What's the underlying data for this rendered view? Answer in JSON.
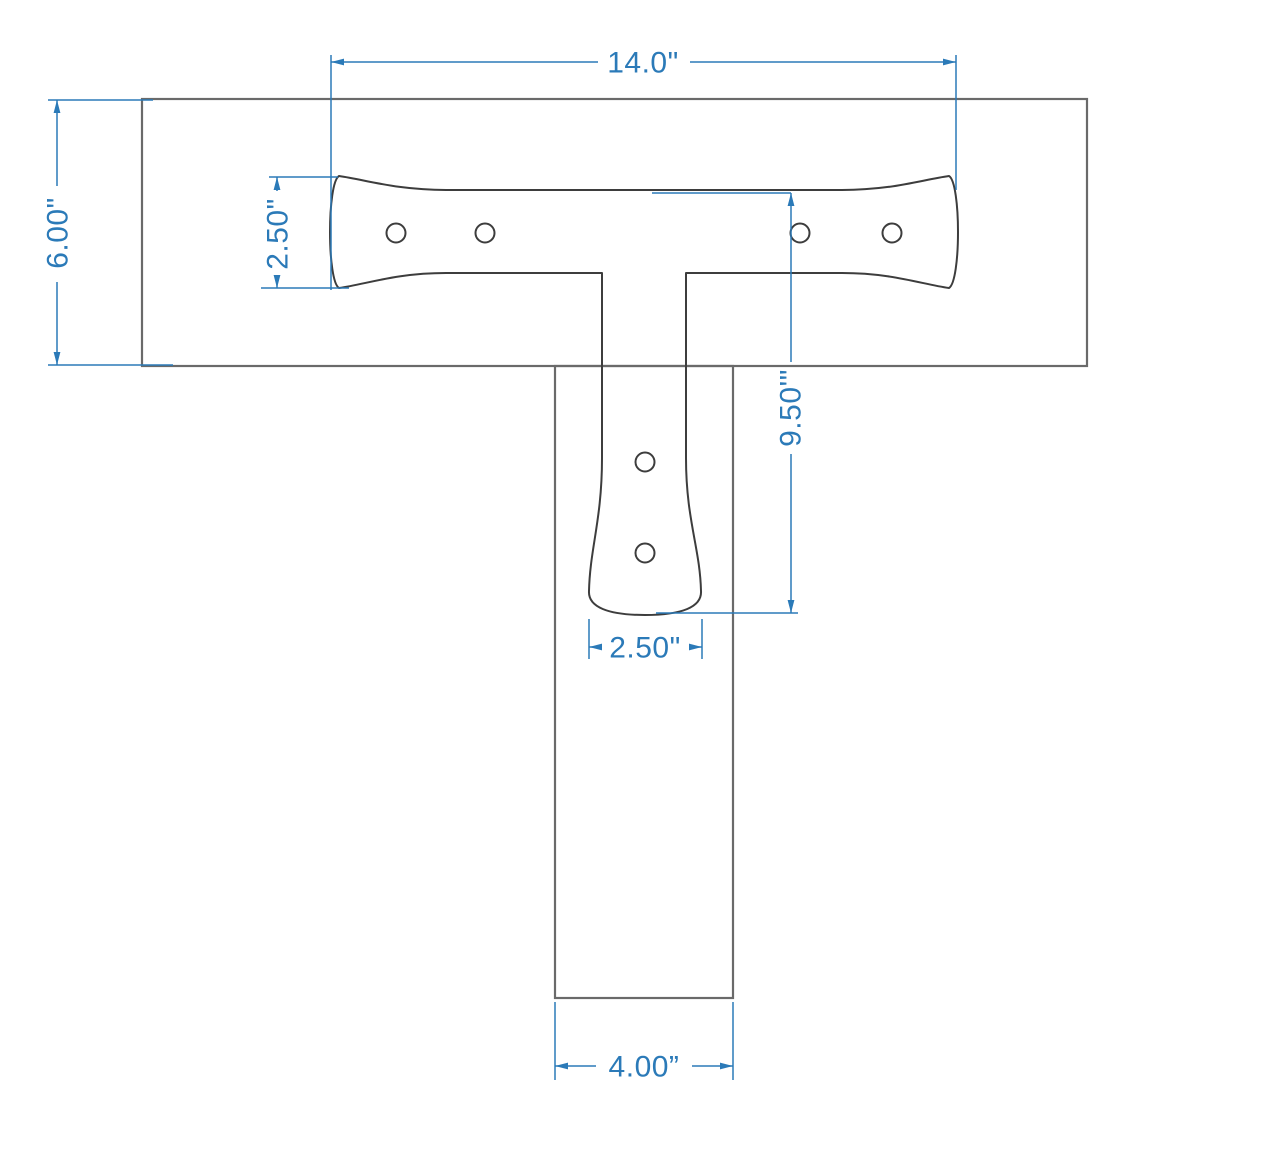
{
  "drawing": {
    "type": "dimensioned-technical-drawing",
    "subject": "T-shaped tie plate over post and beam joint",
    "units": "inches"
  },
  "colors": {
    "background": "#ffffff",
    "dimension_blue": "#2b7ab8",
    "plate_outline": "#3d3d3d",
    "lumber_outline": "#6a6a6a"
  },
  "dimensions": {
    "plate_width": {
      "label": "14.0\"",
      "value": 14.0
    },
    "beam_depth": {
      "label": "6.00\"",
      "value": 6.0
    },
    "plate_end_height": {
      "label": "2.50\"",
      "value": 2.5
    },
    "plate_vertical_length": {
      "label": "9.50'\"",
      "value": 9.5
    },
    "leg_end_width": {
      "label": "2.50\"",
      "value": 2.5
    },
    "post_width": {
      "label": "4.00”",
      "value": 4.0
    }
  },
  "features": {
    "strap_bolt_holes": 4,
    "leg_bolt_holes": 2
  }
}
